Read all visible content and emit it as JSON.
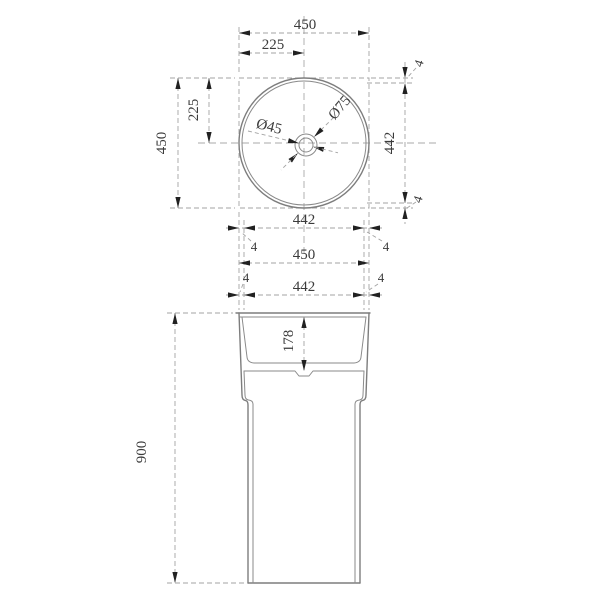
{
  "drawing_type": "technical-dimension-drawing",
  "subject": "pedestal-basin",
  "colors": {
    "background": "#ffffff",
    "object_line": "#7d7d7d",
    "dimension_line": "#a3a3a3",
    "text": "#3b3b3b",
    "arrowhead": "#212121"
  },
  "top_view": {
    "dim_width_total": "450",
    "dim_width_half": "225",
    "dim_height_total": "450",
    "dim_height_half": "225",
    "dim_inner_diameter_v": "442",
    "dim_rim_top": "4",
    "dim_rim_bottom": "4",
    "drain_small": "Ø45",
    "drain_large": "Ø75"
  },
  "middle_dims": {
    "dim_inner_width_top": "442",
    "dim_outer_width": "450",
    "dim_inner_width_bottom": "442",
    "rim_labels": [
      "4",
      "4",
      "4",
      "4"
    ]
  },
  "front_view": {
    "dim_basin_depth": "178",
    "dim_total_height": "900"
  }
}
